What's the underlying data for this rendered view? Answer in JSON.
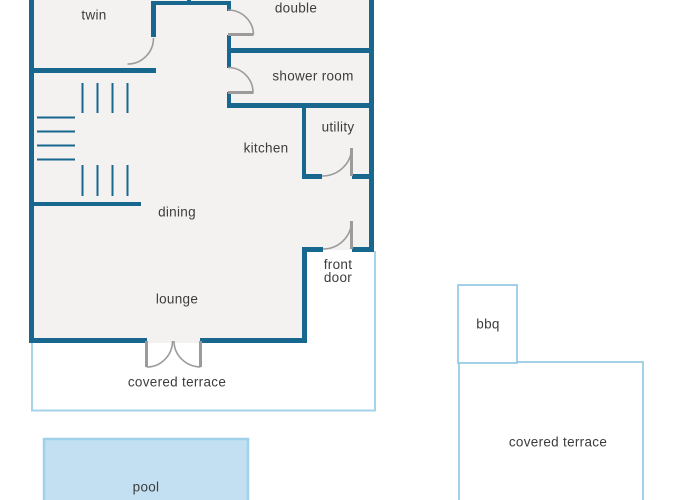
{
  "palette": {
    "background": "#ffffff",
    "wall": "#17678f",
    "door": "#9b9b9b",
    "interior": "#f3f2f0",
    "terrace": "#a5d3ea",
    "patio": "#8cc6e3",
    "pool_fill": "#c2e0f2",
    "pool_border": "#9fd2ea",
    "text": "#3c3c3c"
  },
  "labels": {
    "twin": "twin",
    "double": "double",
    "shower_room": "shower room",
    "utility": "utility",
    "kitchen": "kitchen",
    "dining": "dining",
    "lounge": "lounge",
    "front_door": "front door",
    "covered_terrace_main": "covered terrace",
    "bbq": "bbq",
    "covered_terrace_side": "covered terrace",
    "pool": "pool"
  }
}
